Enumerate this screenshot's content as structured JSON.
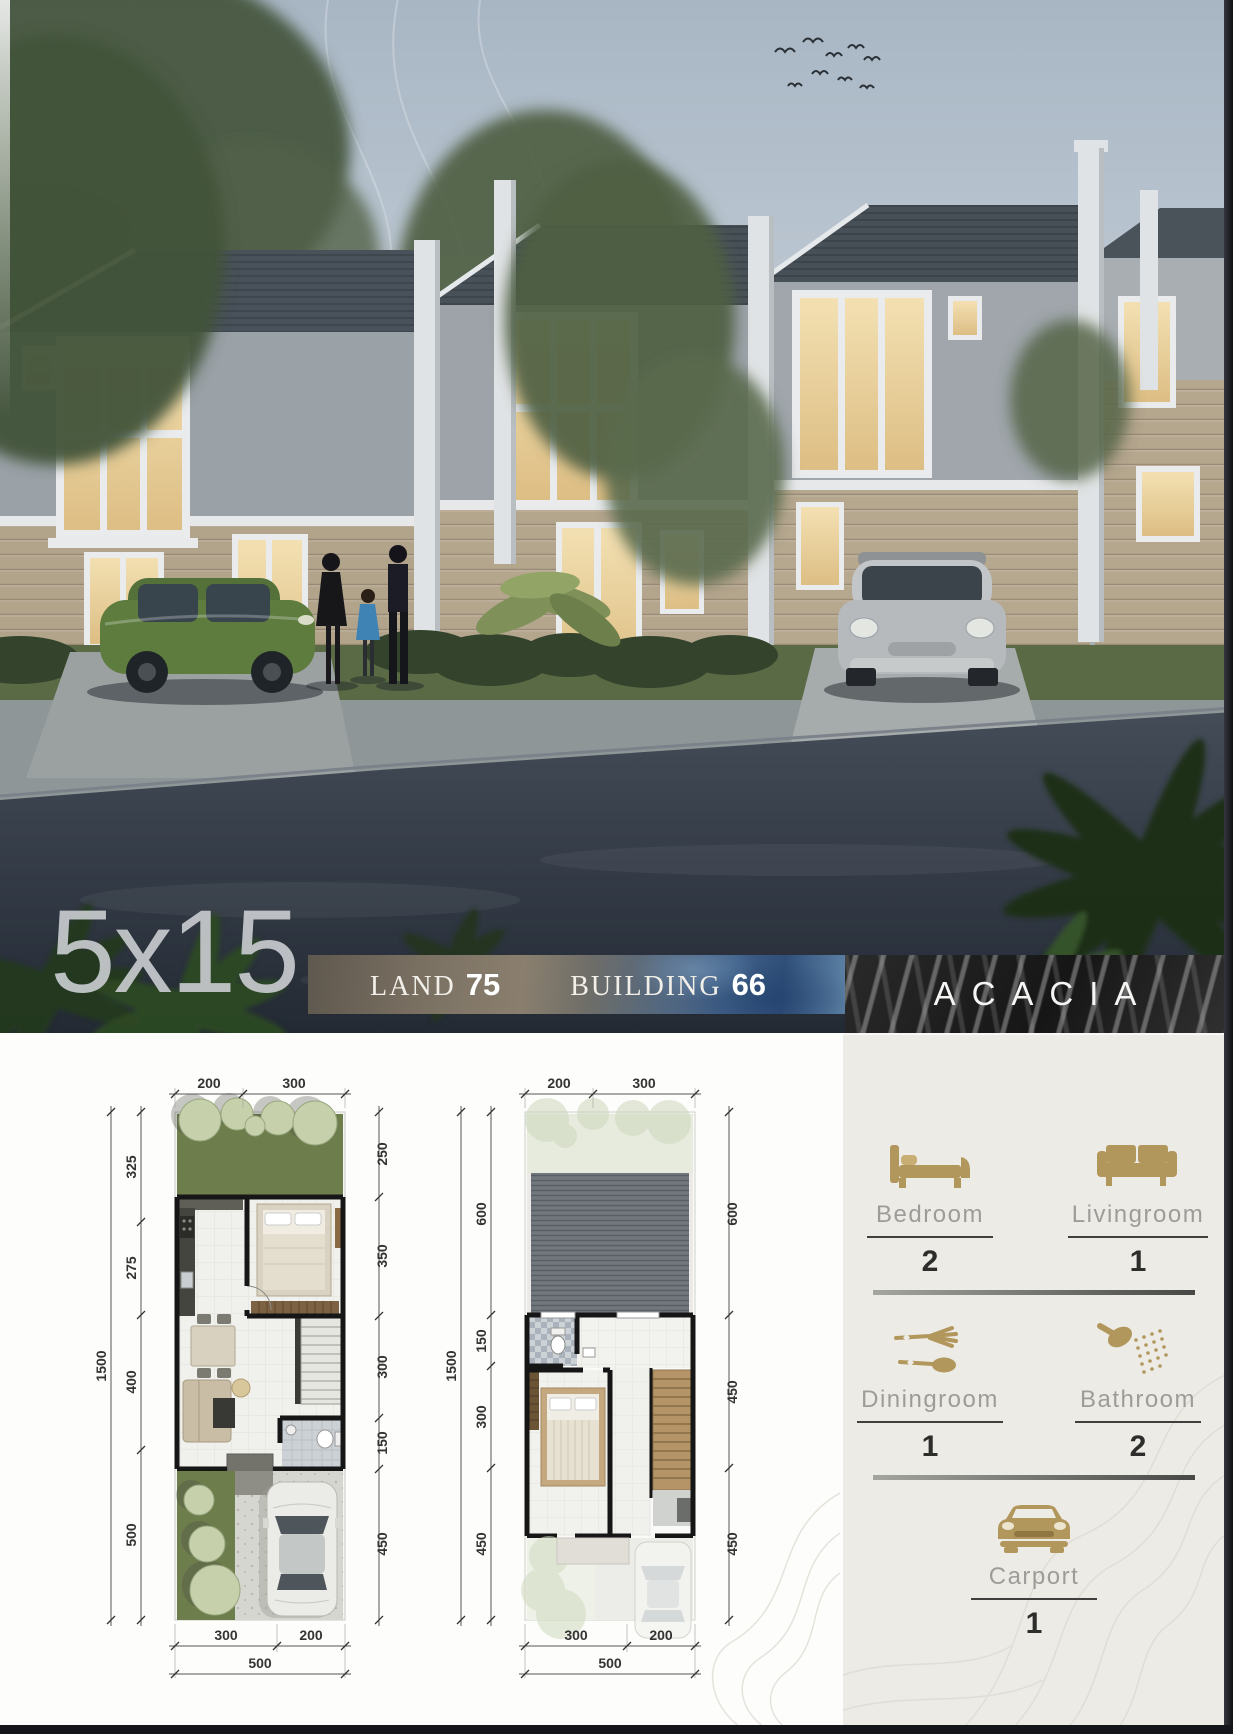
{
  "banner": {
    "size": "5x15",
    "land_label": "LAND",
    "land_value": "75",
    "building_label": "BUILDING",
    "building_value": "66",
    "brand": "ACACIA"
  },
  "plan1": {
    "top_dims": [
      "200",
      "300"
    ],
    "left_total": "1500",
    "left_dims": [
      "325",
      "275",
      "400",
      "500"
    ],
    "right_dims": [
      "250",
      "350",
      "300",
      "150",
      "450"
    ],
    "bottom_dims": [
      "300",
      "200"
    ],
    "bottom_total": "500"
  },
  "plan2": {
    "top_dims": [
      "200",
      "300"
    ],
    "left_total": "1500",
    "left_dims": [
      "600",
      "150",
      "300",
      "450"
    ],
    "right_dims": [
      "600",
      "450",
      "450"
    ],
    "bottom_dims": [
      "300",
      "200"
    ],
    "bottom_total": "500"
  },
  "legend": {
    "items": [
      {
        "label": "Bedroom",
        "count": "2",
        "icon": "bed-icon"
      },
      {
        "label": "Livingroom",
        "count": "1",
        "icon": "sofa-icon"
      },
      {
        "label": "Diningroom",
        "count": "1",
        "icon": "cutlery-icon"
      },
      {
        "label": "Bathroom",
        "count": "2",
        "icon": "shower-icon"
      },
      {
        "label": "Carport",
        "count": "1",
        "icon": "car-icon"
      }
    ]
  },
  "colors": {
    "gold": "#b2975c",
    "band_taupe": "#7b7163",
    "band_blue": "#416189",
    "panel_bg": "#edebe6"
  }
}
